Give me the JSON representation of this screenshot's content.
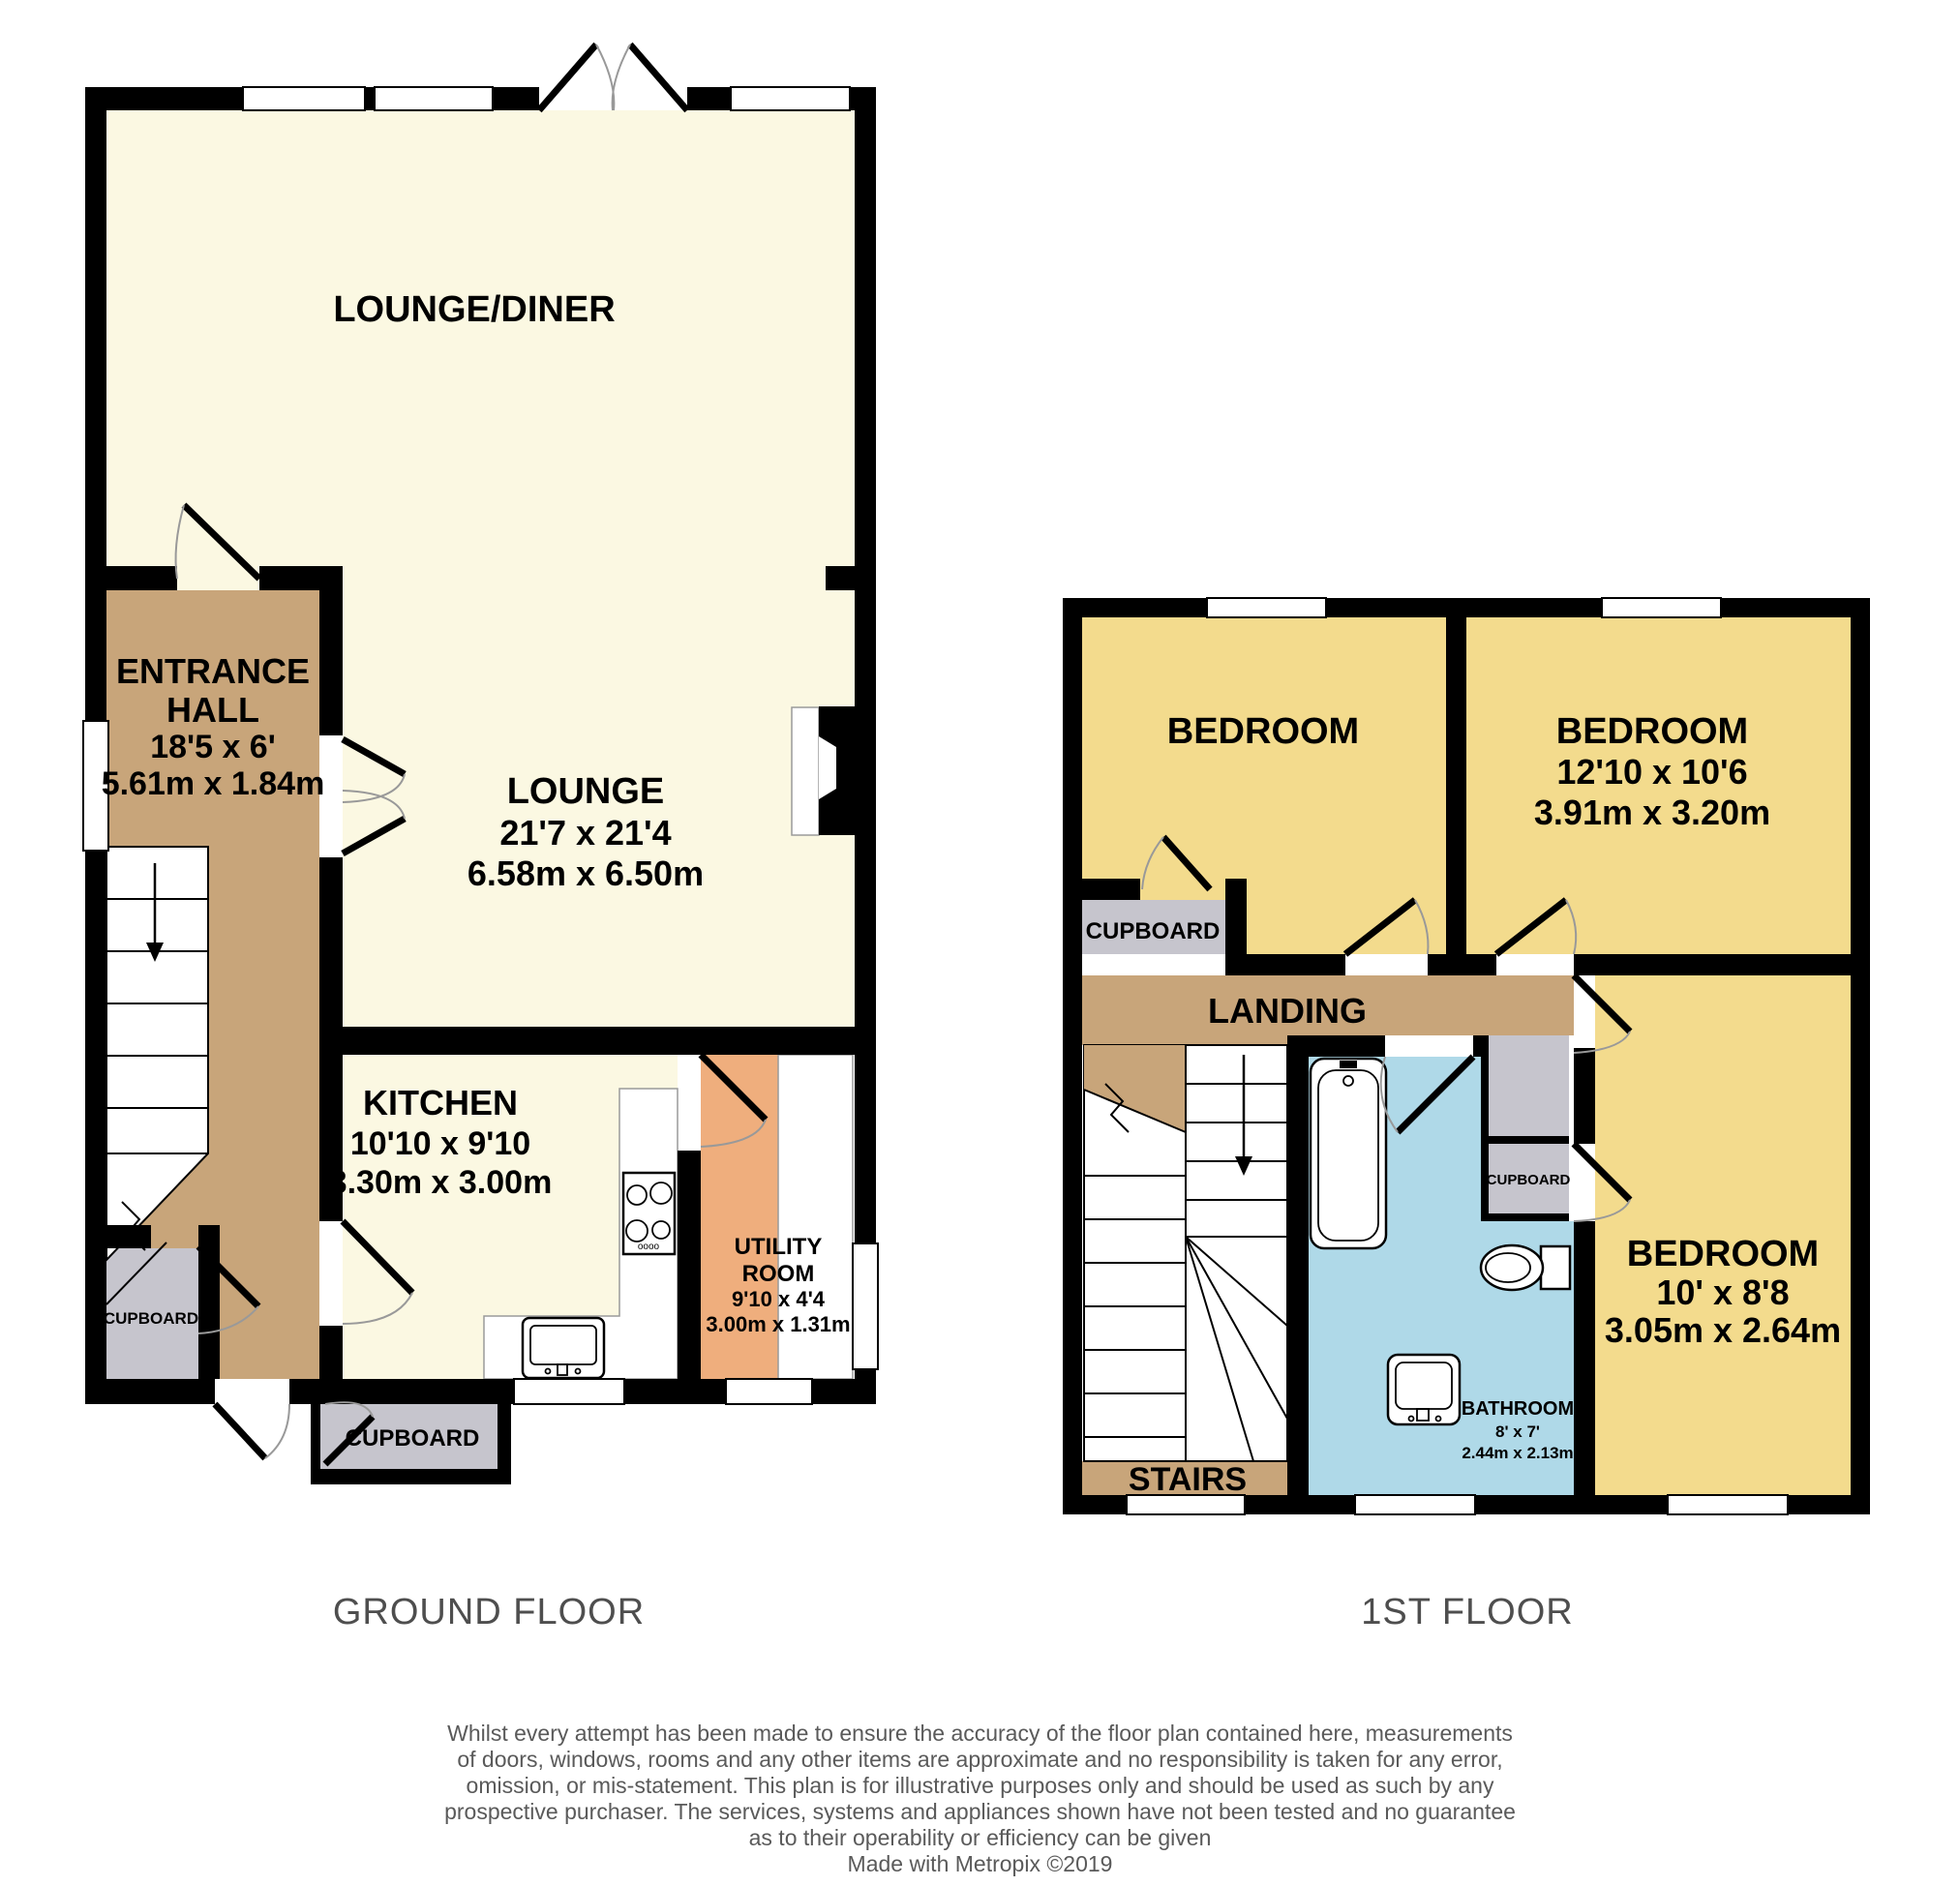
{
  "ground": {
    "floor_label": "GROUND FLOOR",
    "lounge_diner": {
      "name": "LOUNGE/DINER"
    },
    "entrance_hall": {
      "line1": "ENTRANCE",
      "line2": "HALL",
      "dims_ft": "18'5 x 6'",
      "dims_m": "5.61m x 1.84m"
    },
    "lounge": {
      "name": "LOUNGE",
      "dims_ft": "21'7 x 21'4",
      "dims_m": "6.58m x 6.50m"
    },
    "kitchen": {
      "name": "KITCHEN",
      "dims_ft": "10'10 x 9'10",
      "dims_m": "3.30m x 3.00m"
    },
    "utility": {
      "line1": "UTILITY",
      "line2": "ROOM",
      "dims_ft": "9'10 x 4'4",
      "dims_m": "3.00m x 1.31m"
    },
    "cupboard_hall": {
      "name": "CUPBOARD"
    },
    "cupboard_rear": {
      "name": "CUPBOARD"
    },
    "stove_text": "oooo"
  },
  "first": {
    "floor_label": "1ST FLOOR",
    "bedroom_one": {
      "name": "BEDROOM"
    },
    "bedroom_two": {
      "name": "BEDROOM",
      "dims_ft": "12'10 x 10'6",
      "dims_m": "3.91m x 3.20m"
    },
    "bedroom_three": {
      "name": "BEDROOM",
      "dims_ft": "10' x 8'8",
      "dims_m": "3.05m x 2.64m"
    },
    "landing": {
      "name": "LANDING"
    },
    "stairs": {
      "name": "STAIRS"
    },
    "bathroom": {
      "name": "BATHROOM",
      "dims_ft": "8' x 7'",
      "dims_m": "2.44m x 2.13m"
    },
    "cupboard_landing": {
      "name": "CUPBOARD"
    },
    "cupboard_bedroom": {
      "name": "CUPBOARD"
    }
  },
  "disclaimer": {
    "lines": [
      "Whilst every attempt has been made to ensure the accuracy of the floor plan contained here, measurements",
      "of doors, windows, rooms and any other items are approximate and no responsibility is taken for any error,",
      "omission, or mis-statement. This plan is for illustrative purposes only and should be used as such by any",
      "prospective purchaser. The services, systems and appliances shown have not been tested and no guarantee",
      "as to their operability or efficiency can be given"
    ],
    "credit": "Made with Metropix ©2019"
  },
  "colors": {
    "wall": "#000000",
    "room_cream": "#FBF8E2",
    "hall_brown": "#C8A57A",
    "bedroom_yellow": "#F3DB8D",
    "bathroom_blue": "#AFD9E8",
    "cupboard_grey": "#C6C5CD",
    "utility_orange": "#EFAE7D",
    "fixture_white": "#FFFFFF",
    "floor_label_grey": "#4E4E4E",
    "disclaimer_grey": "#5A5A5A",
    "arc_grey": "#999999"
  }
}
